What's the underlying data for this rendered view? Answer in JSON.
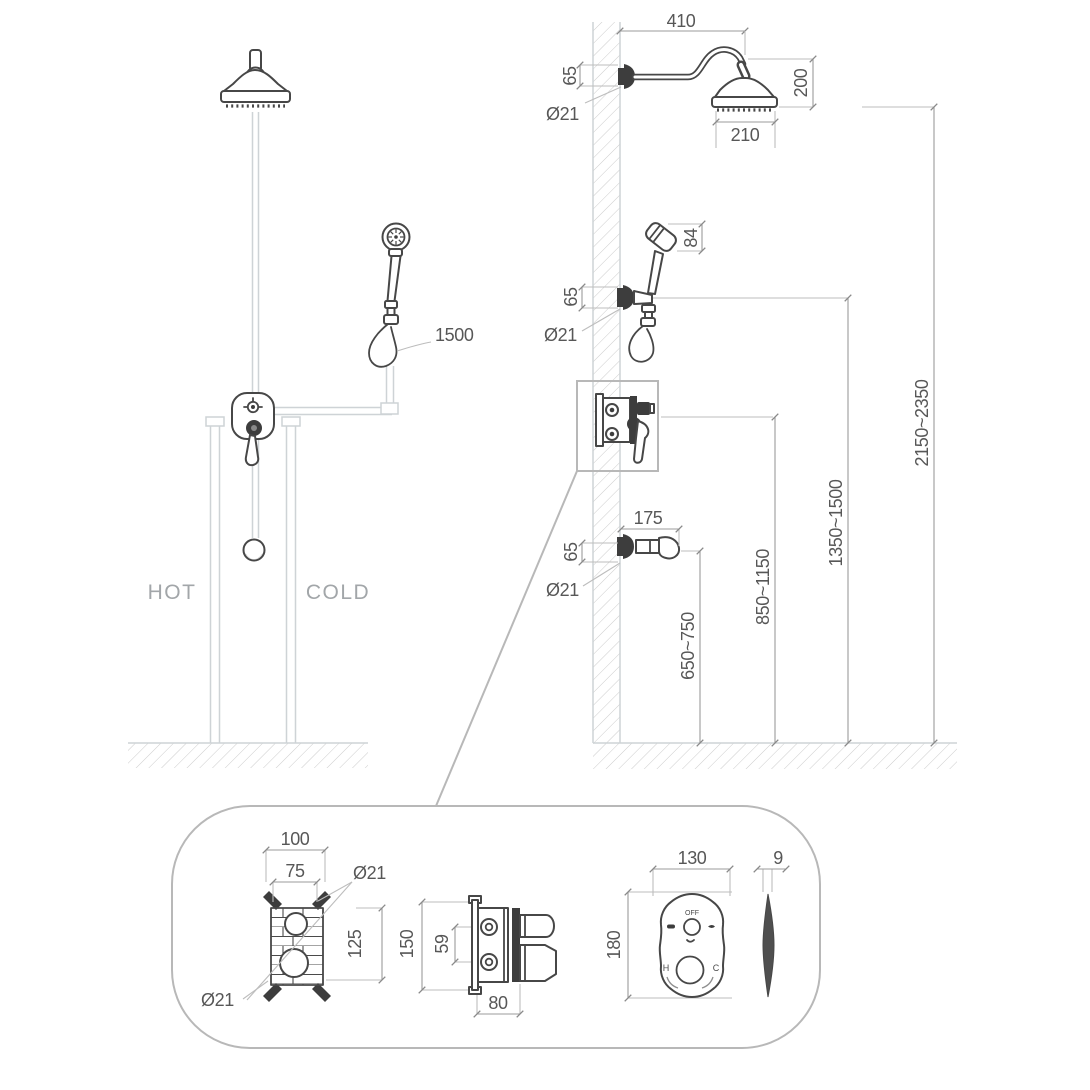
{
  "diagram": {
    "colors": {
      "ink": "#474747",
      "dimension_line": "#9b9b9b",
      "dimension_text": "#575757",
      "pipe_light": "#ced3d6",
      "muted_label": "#a2a6a9",
      "background": "#ffffff"
    },
    "front_view": {
      "hot": "HOT",
      "cold": "COLD",
      "hose_length": "1500"
    },
    "side_view": {
      "arm_reach": "410",
      "arm_height": "65",
      "arm_diameter": "Ø21",
      "head_drop": "200",
      "head_diameter": "210",
      "handshower_length": "84",
      "handshower_height": "65",
      "handshower_diameter": "Ø21",
      "spout_length": "175",
      "spout_height": "65",
      "spout_diameter": "Ø21",
      "height_spout": "650~750",
      "height_valve": "850~1150",
      "height_handshower": "1350~1500",
      "height_showerhead": "2150~2350"
    },
    "detail": {
      "body_width_outer": "100",
      "body_width_inner": "75",
      "port_diameter_top": "Ø21",
      "body_height_inner": "125",
      "port_diameter_bottom": "Ø21",
      "body_height_outer": "150",
      "port_spacing": "59",
      "body_depth": "80",
      "plate_width": "130",
      "plate_height": "180",
      "plate_thickness": "9",
      "dial_off": "OFF",
      "dial_hot": "H",
      "dial_cold": "C"
    }
  }
}
